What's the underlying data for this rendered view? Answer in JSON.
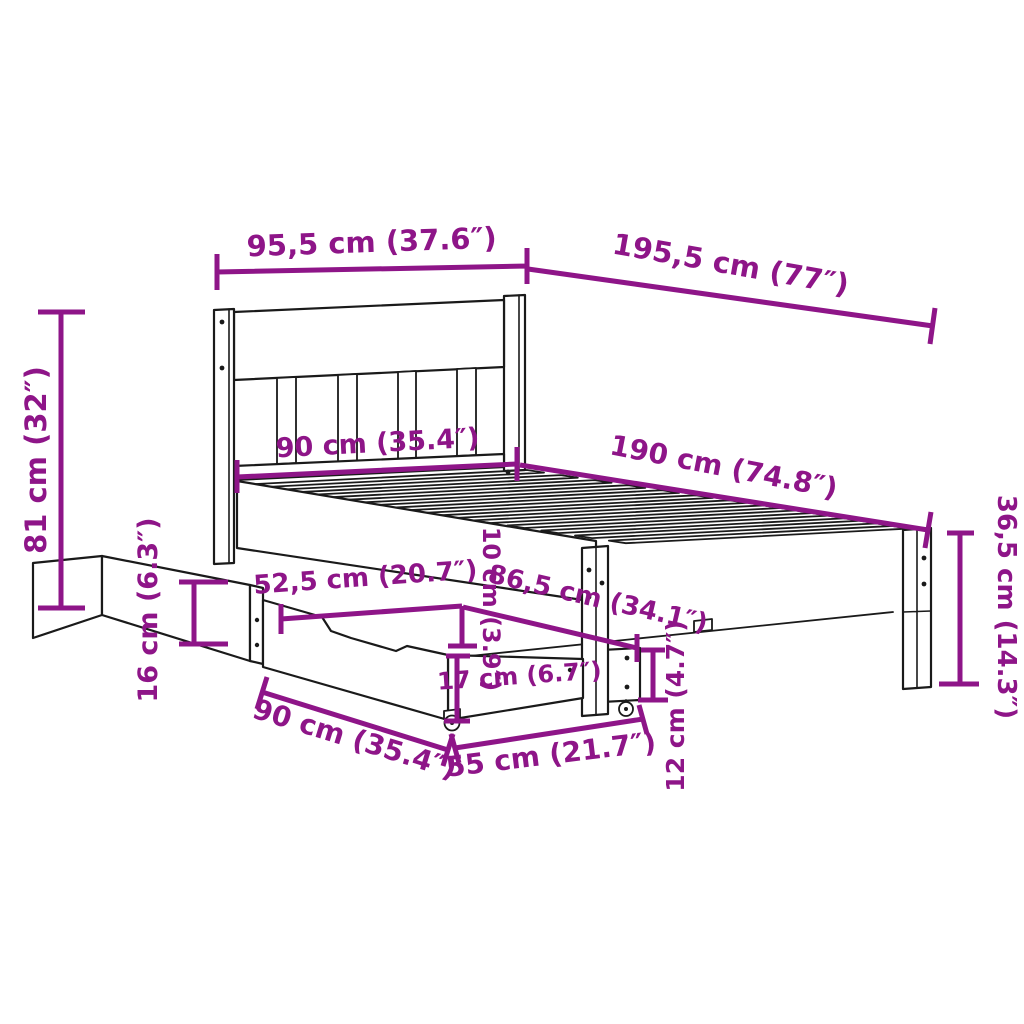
{
  "diagram": {
    "subject": "wooden bed frame with slatted headboard and two storage drawers on casters",
    "background_color": "#FFFFFF",
    "artwork_color": "#1A1A1A",
    "dimension_color": "#8E1588",
    "units": [
      "cm",
      "inches"
    ]
  },
  "dimensions": [
    {
      "id": "headboard-width",
      "cm": 95.5,
      "inches": 37.6,
      "label": "95,5 cm (37.6″)"
    },
    {
      "id": "frame-length-overall",
      "cm": 195.5,
      "inches": 77,
      "label": "195,5 cm (77″)"
    },
    {
      "id": "headboard-height",
      "cm": 81,
      "inches": 32,
      "label": "81 cm (32″)"
    },
    {
      "id": "bed-width-internal",
      "cm": 90,
      "inches": 35.4,
      "label": "90 cm (35.4″)"
    },
    {
      "id": "bed-length-internal",
      "cm": 190,
      "inches": 74.8,
      "label": "190 cm (74.8″)"
    },
    {
      "id": "foot-end-height",
      "cm": 36.5,
      "inches": 14.3,
      "label": "36,5 cm (14.3″)"
    },
    {
      "id": "drawer-side-height",
      "cm": 16,
      "inches": 6.3,
      "label": "16 cm (6.3″)"
    },
    {
      "id": "drawer-depth",
      "cm": 52.5,
      "inches": 20.7,
      "label": "52,5 cm (20.7″)"
    },
    {
      "id": "side-rail-height",
      "cm": 10,
      "inches": 3.9,
      "label": "10 cm (3.9″)"
    },
    {
      "id": "under-bed-length",
      "cm": 86.5,
      "inches": 34.1,
      "label": "86,5 cm (34.1″)"
    },
    {
      "id": "under-bed-drawer-height",
      "cm": 12,
      "inches": 4.7,
      "label": "12 cm (4.7″)"
    },
    {
      "id": "drawer-front-height",
      "cm": 17,
      "inches": 6.7,
      "label": "17 cm (6.7″)"
    },
    {
      "id": "drawer-width",
      "cm": 90,
      "inches": 35.4,
      "label": "90 cm (35.4″)"
    },
    {
      "id": "under-bed-drawer-width",
      "cm": 55,
      "inches": 21.7,
      "label": "55 cm (21.7″)"
    }
  ]
}
